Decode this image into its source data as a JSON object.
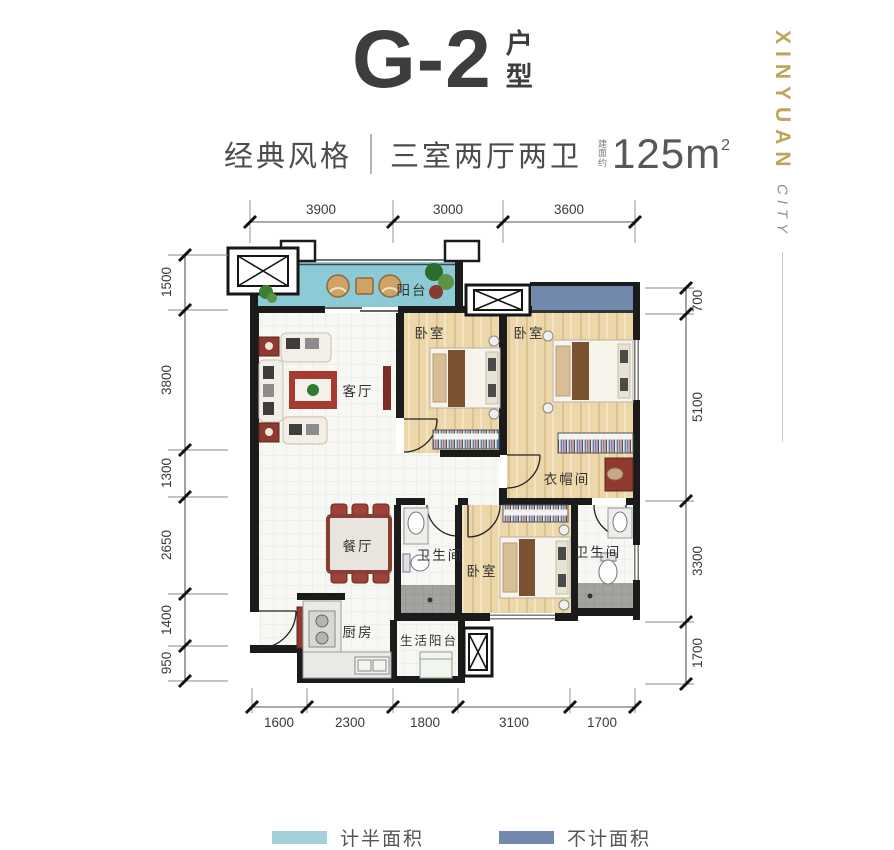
{
  "title": {
    "main": "G-2",
    "suffix": "户型"
  },
  "subtitle": {
    "style": "经典风格",
    "rooms": "三室两厅两卫",
    "area_prefix": "建面约",
    "area_value": "125m",
    "area_exp": "2"
  },
  "branding": {
    "primary": "XINYUAN",
    "secondary": "CITY"
  },
  "rooms": {
    "balcony": "阳台",
    "living": "客厅",
    "bedroom": "卧室",
    "cloakroom": "衣帽间",
    "bathroom": "卫生间",
    "dining": "餐厅",
    "kitchen": "厨房",
    "service_balcony": "生活阳台"
  },
  "dims": {
    "top": [
      "3900",
      "3000",
      "3600"
    ],
    "bottom": [
      "1600",
      "2300",
      "1800",
      "3100",
      "1700"
    ],
    "left": [
      "1500",
      "3800",
      "1300",
      "2650",
      "1400",
      "950"
    ],
    "right": [
      "700",
      "5100",
      "3300",
      "1700"
    ]
  },
  "legend": {
    "half_label": "计半面积",
    "half_color": "#a3d1d9",
    "none_label": "不计面积",
    "none_color": "#7089ad"
  },
  "colors": {
    "balcony_fill": "#8ccad5",
    "bay_window_fill": "#7089ad"
  }
}
